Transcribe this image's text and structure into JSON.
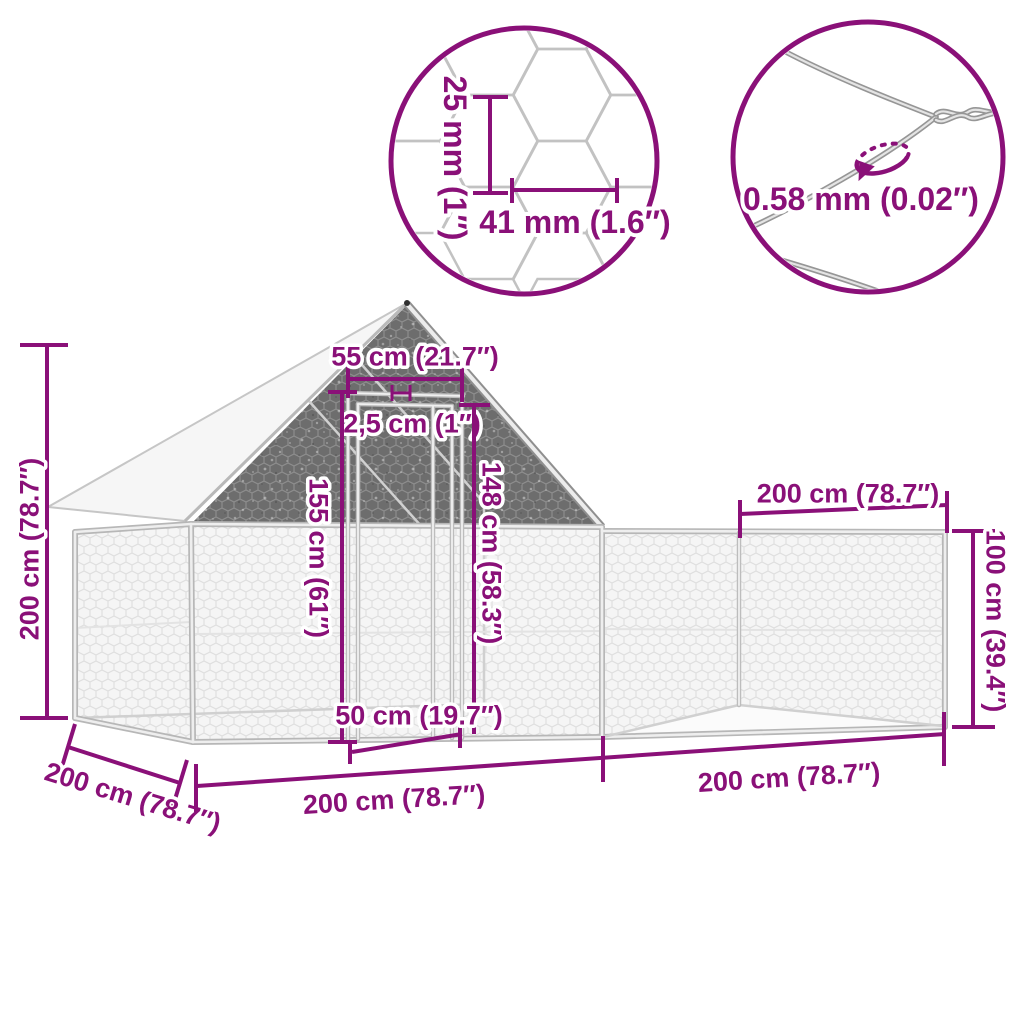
{
  "insets": {
    "mesh": {
      "cell_height_label": "25 mm (1″)",
      "cell_width_label": "41 mm (1.6″)"
    },
    "wire": {
      "thickness_label": "0.58 mm (0.02″)"
    }
  },
  "dimensions": {
    "total_height": "200 cm (78.7″)",
    "ridge_width": "55 cm (21.7″)",
    "frame_tube": "2,5 cm (1″)",
    "door_height": "155 cm (61″)",
    "wall_height": "148 cm (58.3″)",
    "door_width": "50 cm (19.7″)",
    "run_length_top": "200 cm (78.7″)",
    "run_height": "100 cm (39.4″)",
    "depth": "200 cm (78.7″)",
    "coop_section_length": "200 cm (78.7″)",
    "run_section_length": "200 cm (78.7″)"
  },
  "colors": {
    "accent": "#8a1078",
    "mesh_shadow": "#6d6d6d",
    "frame": "#bdbdbd",
    "roof": "#f6f6f6"
  }
}
